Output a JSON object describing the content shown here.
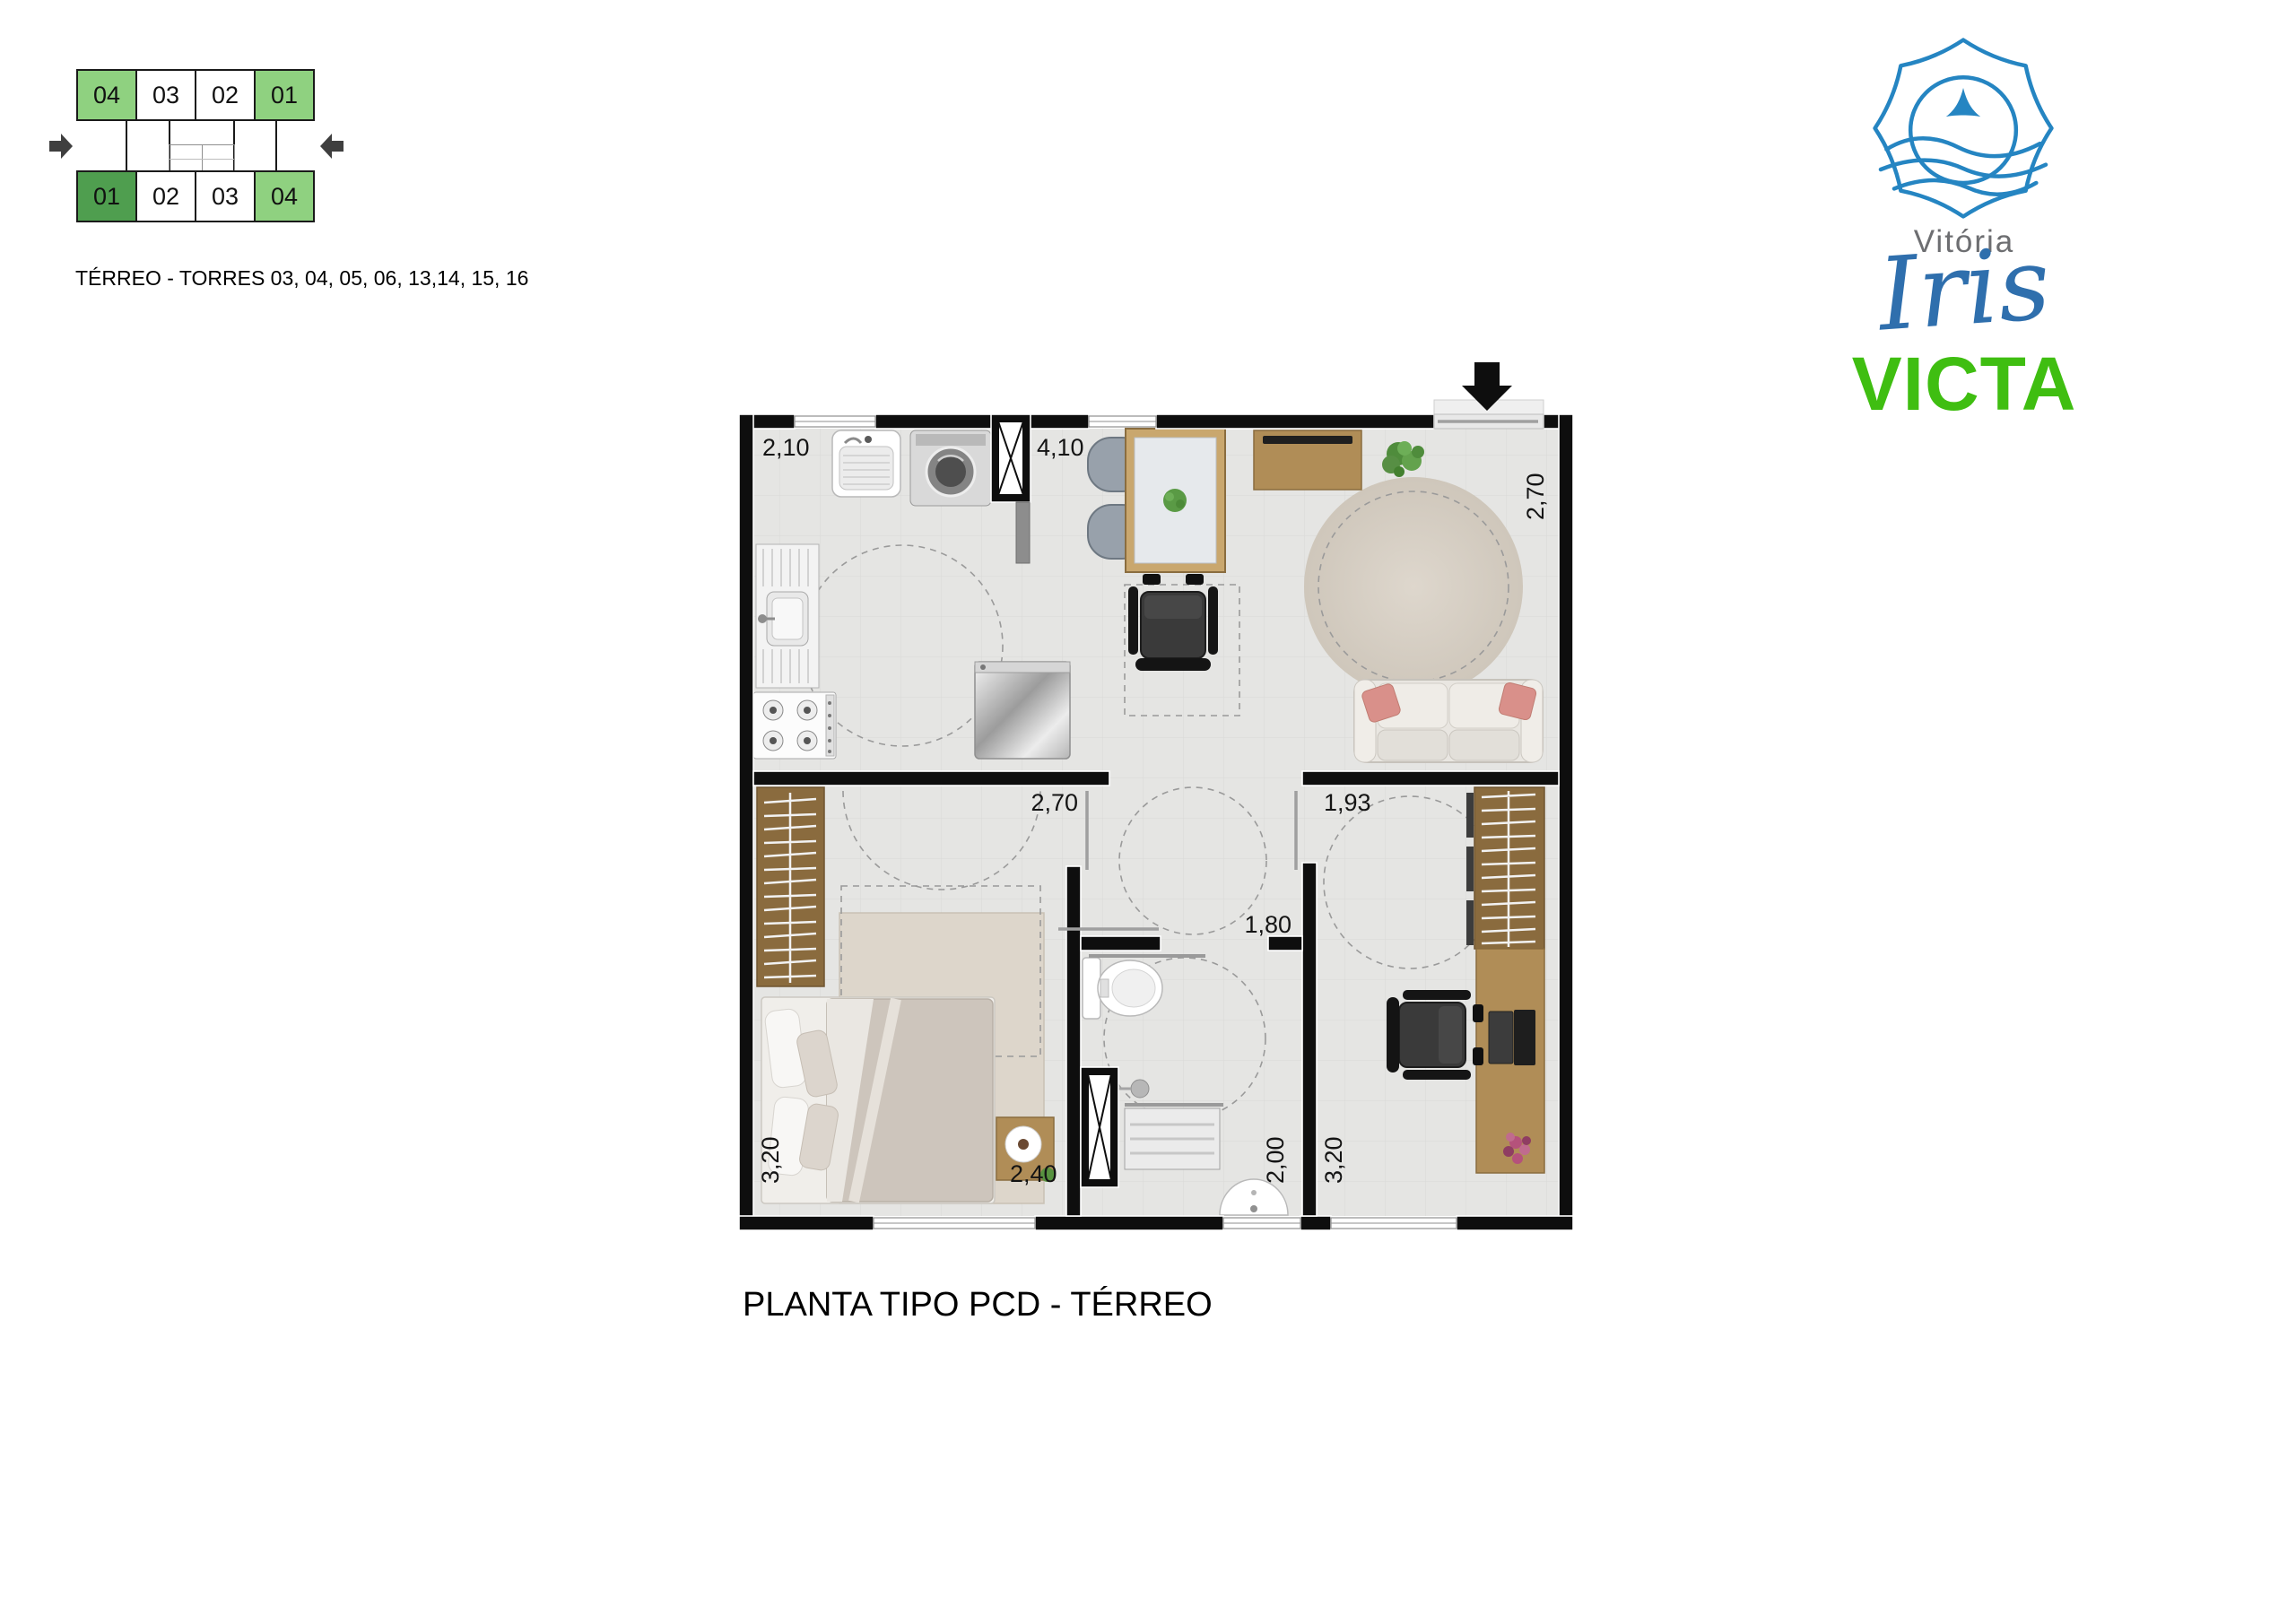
{
  "key_diagram": {
    "top_row": [
      {
        "label": "04",
        "color": "#8fd180"
      },
      {
        "label": "03",
        "color": "#ffffff"
      },
      {
        "label": "02",
        "color": "#ffffff"
      },
      {
        "label": "01",
        "color": "#8fd180"
      }
    ],
    "bottom_row": [
      {
        "label": "01",
        "color": "#4f9e4f"
      },
      {
        "label": "02",
        "color": "#ffffff"
      },
      {
        "label": "03",
        "color": "#ffffff"
      },
      {
        "label": "04",
        "color": "#8fd180"
      }
    ],
    "caption": "TÉRREO - TORRES 03, 04, 05, 06, 13,14, 15, 16"
  },
  "logo": {
    "city": "Vitória",
    "name": "Iris",
    "brand": "VICTA"
  },
  "plan": {
    "title": "PLANTA TIPO PCD - TÉRREO",
    "dimensions": {
      "service_width": "2,10",
      "kitchen_living_width": "4,10",
      "living_depth": "2,70",
      "bedroom1_width": "2,70",
      "bedroom2_entry": "1,93",
      "bathroom_width": "1,80",
      "bathroom_depth": "2,00",
      "bedroom1_depth": "3,20",
      "bedroom1_bottom": "2,40",
      "bedroom2_depth": "3,20"
    }
  },
  "colors": {
    "light_green": "#8fd180",
    "dark_green": "#4f9e4f",
    "arrow_gray": "#3f3f3f",
    "logo_blue": "#2585c2",
    "iris_blue": "#2f6fad",
    "victa_green": "#3fbe11",
    "vitoria_gray": "#6d6e71",
    "wall_black": "#0e0e0e"
  }
}
